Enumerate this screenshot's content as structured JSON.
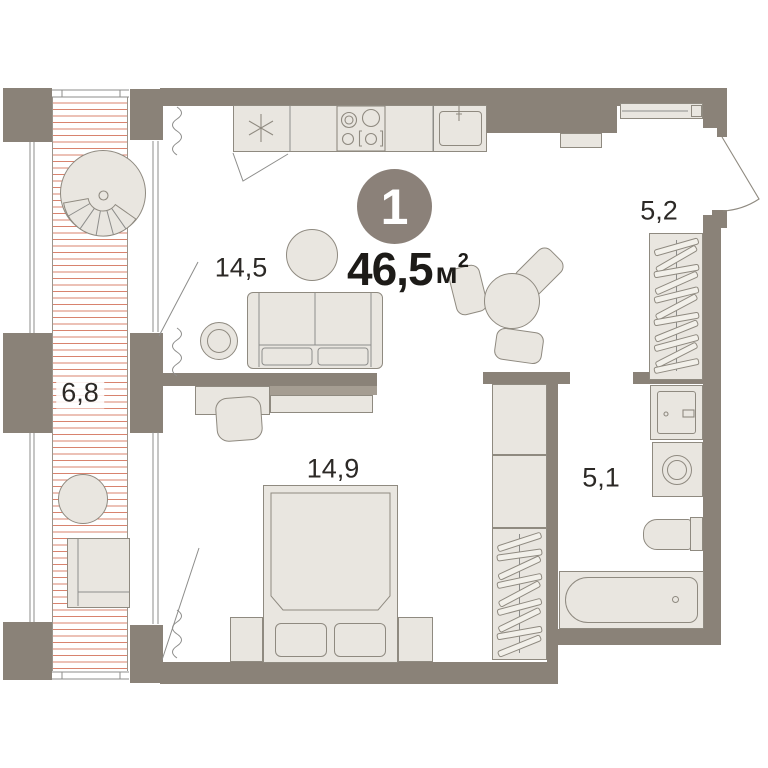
{
  "plan": {
    "badge": {
      "room_count": "1",
      "total_area": "46,5",
      "unit": "м",
      "unit_exp": "2"
    },
    "rooms": {
      "living": {
        "area": "14,5"
      },
      "bedroom": {
        "area": "14,9"
      },
      "balcony": {
        "area": "6,8"
      },
      "hallway": {
        "area": "5,2"
      },
      "bathroom": {
        "area": "5,1"
      }
    },
    "icons": {
      "fridge": "snowflake-icon",
      "stove": "burners-icon",
      "windows": "zigzag-icon",
      "entrance_door": "door-swing-icon",
      "wardrobes": "hanger-icon"
    },
    "colors": {
      "wall": "#8a8278",
      "furniture_fill": "#e9e6e0",
      "furniture_stroke": "#8f8a80",
      "hatch": "#d8836e",
      "badge_bg": "#8b8179",
      "badge_text": "#ffffff",
      "label": "#2c2926",
      "floor": "#ffffff",
      "background": "#ffffff"
    }
  }
}
